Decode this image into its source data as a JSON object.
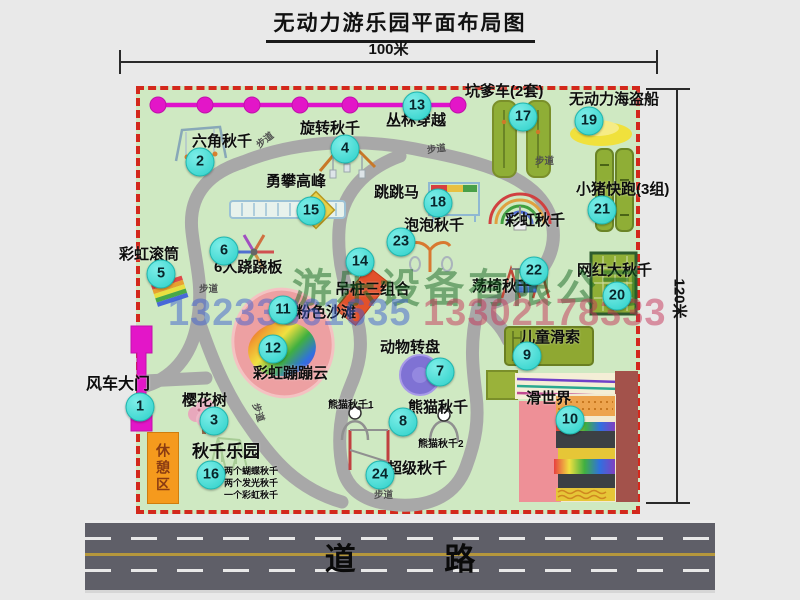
{
  "title": "无动力游乐园平面布局图",
  "dimensions": {
    "top": "100米",
    "right": "120米"
  },
  "road_label": "道 路",
  "rest_area_label": "休憩区",
  "watermark": {
    "company": "游乐设备有限公司",
    "phone1": "13233861635",
    "phone2": "13302178333"
  },
  "colors": {
    "map_bg": "#cfe9c2",
    "border_red": "#d3281c",
    "magenta": "#e316c8",
    "marker_cyan": "#2cd0c9",
    "path_gray": "#a8a8a8",
    "pad_green": "#8fae36",
    "road_gray": "#5f5f68",
    "rest_orange": "#f59a1d",
    "pink_beach": "#eda0a2",
    "carousel_purple": "#7f72d4",
    "boat_yellow": "#f0e13c"
  },
  "attractions": [
    {
      "num": 1,
      "name": "风车大门",
      "marker": {
        "x": 140,
        "y": 407
      },
      "label": {
        "x": 86,
        "y": 377,
        "size": 16
      }
    },
    {
      "num": 2,
      "name": "六角秋千",
      "marker": {
        "x": 200,
        "y": 162
      },
      "label": {
        "x": 192,
        "y": 134
      }
    },
    {
      "num": 3,
      "name": "樱花树",
      "marker": {
        "x": 214,
        "y": 421
      },
      "label": {
        "x": 182,
        "y": 393
      }
    },
    {
      "num": 4,
      "name": "旋转秋千",
      "marker": {
        "x": 345,
        "y": 149
      },
      "label": {
        "x": 300,
        "y": 121
      }
    },
    {
      "num": 5,
      "name": "彩虹滚筒",
      "marker": {
        "x": 161,
        "y": 274
      },
      "label": {
        "x": 119,
        "y": 247
      }
    },
    {
      "num": 6,
      "name": "6人跷跷板",
      "marker": {
        "x": 224,
        "y": 251
      },
      "label": {
        "x": 214,
        "y": 260
      }
    },
    {
      "num": 7,
      "name": "动物转盘",
      "marker": {
        "x": 440,
        "y": 372
      },
      "label": {
        "x": 380,
        "y": 340
      }
    },
    {
      "num": 8,
      "name": "熊猫秋千",
      "marker": {
        "x": 403,
        "y": 422
      },
      "label": {
        "x": 408,
        "y": 400
      }
    },
    {
      "num": 9,
      "name": "儿童滑索",
      "marker": {
        "x": 527,
        "y": 356
      },
      "label": {
        "x": 520,
        "y": 330
      }
    },
    {
      "num": 10,
      "name": "滑世界",
      "marker": {
        "x": 570,
        "y": 420
      },
      "label": {
        "x": 526,
        "y": 391
      }
    },
    {
      "num": 11,
      "name": "粉色沙滩",
      "marker": {
        "x": 283,
        "y": 310
      },
      "label": {
        "x": 296,
        "y": 305
      }
    },
    {
      "num": 12,
      "name": "彩虹蹦蹦云",
      "marker": {
        "x": 273,
        "y": 349
      },
      "label": {
        "x": 253,
        "y": 366
      }
    },
    {
      "num": 13,
      "name": "丛林穿越",
      "marker": {
        "x": 417,
        "y": 106
      },
      "label": {
        "x": 386,
        "y": 113
      }
    },
    {
      "num": 14,
      "name": "吊桩三组合",
      "marker": {
        "x": 360,
        "y": 262
      },
      "label": {
        "x": 335,
        "y": 282
      }
    },
    {
      "num": 15,
      "name": "勇攀高峰",
      "marker": {
        "x": 311,
        "y": 211
      },
      "label": {
        "x": 266,
        "y": 174
      }
    },
    {
      "num": 16,
      "name": "秋千乐园",
      "marker": {
        "x": 211,
        "y": 475
      },
      "label": {
        "x": 192,
        "y": 443,
        "size": 17
      }
    },
    {
      "num": 17,
      "name": "坑爹车(2套)",
      "marker": {
        "x": 523,
        "y": 117
      },
      "label": {
        "x": 465,
        "y": 84
      }
    },
    {
      "num": 18,
      "name": "跳跳马",
      "marker": {
        "x": 438,
        "y": 203
      },
      "label": {
        "x": 374,
        "y": 185
      }
    },
    {
      "num": 19,
      "name": "无动力海盗船",
      "marker": {
        "x": 589,
        "y": 121
      },
      "label": {
        "x": 569,
        "y": 92
      }
    },
    {
      "num": 20,
      "name": "网红大秋千",
      "marker": {
        "x": 617,
        "y": 296
      },
      "label": {
        "x": 577,
        "y": 263
      }
    },
    {
      "num": 21,
      "name": "小猪快跑(3组)",
      "marker": {
        "x": 602,
        "y": 210
      },
      "label": {
        "x": 576,
        "y": 182
      }
    },
    {
      "num": 22,
      "name": "荡椅秋千",
      "marker": {
        "x": 534,
        "y": 271
      },
      "label": {
        "x": 472,
        "y": 279
      }
    },
    {
      "num": 23,
      "name": "泡泡秋千",
      "marker": {
        "x": 401,
        "y": 242
      },
      "label": {
        "x": 404,
        "y": 218
      }
    },
    {
      "num": 24,
      "name": "超级秋千",
      "marker": {
        "x": 380,
        "y": 475
      },
      "label": {
        "x": 387,
        "y": 461
      }
    }
  ],
  "extra_labels": [
    {
      "text": "彩虹秋千",
      "x": 505,
      "y": 213,
      "size": 15
    },
    {
      "text": "熊猫秋千1",
      "x": 328,
      "y": 401,
      "size": 10
    },
    {
      "text": "熊猫秋千2",
      "x": 418,
      "y": 440,
      "size": 10
    },
    {
      "text": "两个蝴蝶秋千",
      "x": 224,
      "y": 467,
      "size": 9
    },
    {
      "text": "两个发光秋千",
      "x": 224,
      "y": 479,
      "size": 9
    },
    {
      "text": "一个彩虹秋千",
      "x": 224,
      "y": 491,
      "size": 9
    }
  ],
  "path_labels": [
    {
      "text": "步道",
      "x": 256,
      "y": 136,
      "rot": -38
    },
    {
      "text": "步道",
      "x": 427,
      "y": 145,
      "rot": -8
    },
    {
      "text": "步道",
      "x": 535,
      "y": 157,
      "rot": 0
    },
    {
      "text": "步道",
      "x": 199,
      "y": 285,
      "rot": 0
    },
    {
      "text": "步道",
      "x": 374,
      "y": 491,
      "rot": 0
    },
    {
      "text": "步道",
      "x": 248,
      "y": 408,
      "rot": 72
    }
  ]
}
